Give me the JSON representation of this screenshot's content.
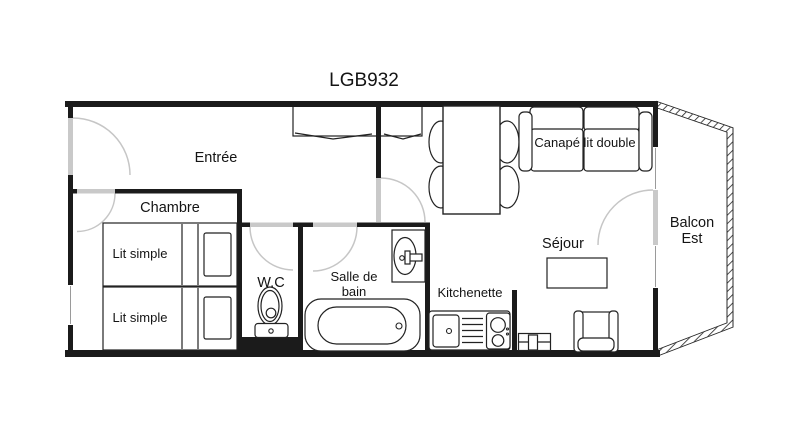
{
  "title": "LGB932",
  "rooms": {
    "entree": {
      "label": "Entrée"
    },
    "chambre": {
      "label": "Chambre"
    },
    "wc": {
      "label": "W.C"
    },
    "bathroom": {
      "line1": "Salle de",
      "line2": "bain"
    },
    "kitchenette": {
      "label": "Kitchenette"
    },
    "sejour": {
      "label": "Séjour"
    },
    "balcony": {
      "line1": "Balcon",
      "line2": "Est"
    }
  },
  "furniture": {
    "bed1": {
      "label": "Lit simple"
    },
    "bed2": {
      "label": "Lit simple"
    },
    "sofa": {
      "label": "Canapé lit double"
    }
  },
  "colors": {
    "wall": "#1b1b1b",
    "door_opening": "#c9c9c9",
    "door_arc": "#c6c6c6",
    "outline": "#222222",
    "background": "#ffffff",
    "text": "#141414"
  }
}
